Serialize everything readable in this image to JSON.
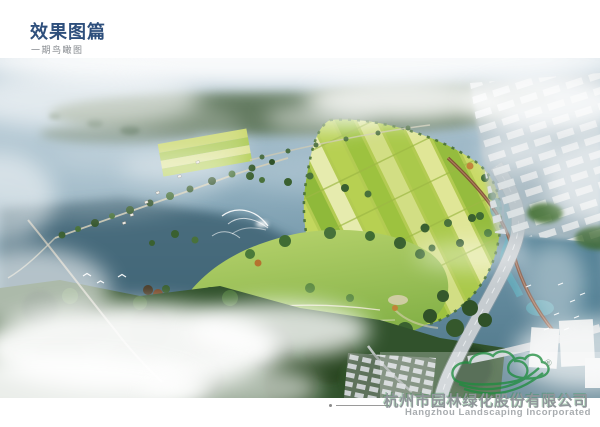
{
  "header": {
    "title": "效果图篇",
    "subtitle": "一期鸟瞰图"
  },
  "footer": {
    "company_cn": "杭州市园林绿化股份有限公司",
    "company_en": "Hangzhou Landscaping Incorporated",
    "registered_mark": "®",
    "logo_icon": "green-cloud-leaf-logo"
  },
  "colors": {
    "title_blue": "#2e4f7c",
    "subtitle_gray": "#85898e",
    "logo_green": "#1f8e3f",
    "company_gray": "#90959a",
    "water_deep": "#3a5e70",
    "water_haze": "#bccdd8",
    "field_yellow": "#d9e176",
    "field_green": "#8fb93a",
    "forest_dark": "#2c4a26",
    "road_gray": "#c6ccd0",
    "road_brown": "#7e4a34"
  }
}
